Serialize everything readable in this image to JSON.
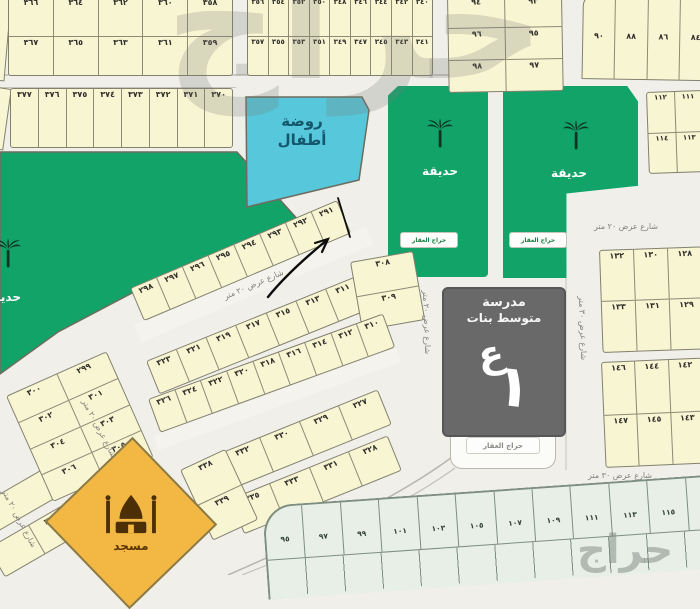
{
  "watermark": {
    "main": "حراج",
    "corner": "حراج"
  },
  "facilities": {
    "kindergarten_line1": "روضة",
    "kindergarten_line2": "أطفال",
    "garden_label": "حديقة",
    "park_label": "حديقة",
    "school_line1": "مدرسة",
    "school_line2": "متوسط بنات",
    "school_mark": "ع",
    "school_mark_stroke": "١",
    "mosque_label": "مسجد",
    "agency_badge": "حراج العقار"
  },
  "streets": {
    "mid_diag": "شارع عرض ٢٠ متر",
    "left_1": "شارع عرض ٢٠ متر",
    "left_2": "شارع عرض ٢٠ متر",
    "school_v": "شارع عرض ٢٠ متر",
    "right_v": "شارع عرض ٣٠ متر",
    "right_h_top": "شارع عرض ٢٠ متر",
    "right_h_bottom": "شارع عرض ٣٠ متر"
  },
  "blocks": {
    "top_a": {
      "rows": [
        [
          "٣٦٦",
          "٣٦٤",
          "٣٦٢",
          "٣٦٠",
          "٣٥٨"
        ],
        [
          "٣٦٧",
          "٣٦٥",
          "٣٦٣",
          "٣٦١",
          "٣٥٩"
        ]
      ]
    },
    "top_b": {
      "rows": [
        [
          "٣٥٦",
          "٣٥٤",
          "٣٥٢",
          "٣٥٠",
          "٣٤٨",
          "٣٤٦",
          "٣٤٤",
          "٣٤٢",
          "٣٤٠"
        ],
        [
          "٣٥٧",
          "٣٥٥",
          "٣٥٣",
          "٣٥١",
          "٣٤٩",
          "٣٤٧",
          "٣٤٥",
          "٣٤٣",
          "٣٤١"
        ]
      ]
    },
    "top_c": {
      "rows": [
        [
          "٩٤",
          "٩٣"
        ],
        [
          "٩٦",
          "٩٥"
        ],
        [
          "٩٨",
          "٩٧"
        ]
      ]
    },
    "top_d": {
      "cells": [
        "٩٠",
        "٨٨",
        "٨٦",
        "٨٤"
      ]
    },
    "strip_e": {
      "cells": [
        "٣٧٧",
        "٣٧٦",
        "٣٧٥",
        "٣٧٤",
        "٣٧٣",
        "٣٧٢",
        "٣٧١",
        "٣٧٠"
      ]
    },
    "row_i": {
      "cells": [
        "٢٩٨",
        "٢٩٧",
        "٢٩٦",
        "٢٩٥",
        "٢٩٤",
        "٢٩٣",
        "٢٩٢",
        "٢٩١"
      ]
    },
    "row_j_outer": {
      "cells": [
        "٣٢٣",
        "٣٢١",
        "٣١٩",
        "٣١٧",
        "٣١٥",
        "٣١٣",
        "٣١١"
      ]
    },
    "col_jr": {
      "cells": [
        "٣٠٨",
        "٣٠٩"
      ]
    },
    "row_j_inner": {
      "cells": [
        "٣٢٦",
        "٣٢٤",
        "٣٢٢",
        "٣٢٠",
        "٣١٨",
        "٣١٦",
        "٣١٤",
        "٣١٢",
        "٣١٠"
      ]
    },
    "row_k_outer": {
      "cells": [
        "٣٣٢",
        "٣٣٠",
        "٣٢٩",
        "٣٢٧"
      ]
    },
    "row_k_inner": {
      "cells": [
        "٣٣٥",
        "٣٣٣",
        "٣٣١",
        "٣٢٨"
      ]
    },
    "col_mosque": {
      "cells": [
        "٣٣٨",
        "٣٣٩"
      ]
    },
    "block_l": {
      "rows": [
        [
          "٣٠٠",
          "٢٩٩"
        ],
        [
          "٣٠٢",
          "٣٠١"
        ],
        [
          "٣٠٤",
          "٣٠٣"
        ],
        [
          "٣٠٦",
          "٣٠٥"
        ]
      ]
    },
    "corner_strip": {
      "cells": [
        "",
        "٣٦٨"
      ]
    },
    "right_1": {
      "rows": [
        [
          "١١٢",
          "١١١"
        ],
        [
          "١١٤",
          "١١٣"
        ]
      ]
    },
    "right_2": {
      "rows": [
        [
          "١٣٢",
          "١٣٠",
          "١٢٨"
        ],
        [
          "١٣٣",
          "١٣١",
          "١٢٩"
        ]
      ]
    },
    "right_3": {
      "rows": [
        [
          "١٤٦",
          "١٤٤",
          "١٤٢"
        ],
        [
          "١٤٧",
          "١٤٥",
          "١٤٣"
        ]
      ]
    },
    "bottom_row": {
      "cells": [
        "٩٥",
        "٩٧",
        "٩٩",
        "١٠١",
        "١٠٣",
        "١٠٥",
        "١٠٧",
        "١٠٩",
        "١١١",
        "١١٣",
        "١١٥",
        "١١٧"
      ]
    }
  }
}
